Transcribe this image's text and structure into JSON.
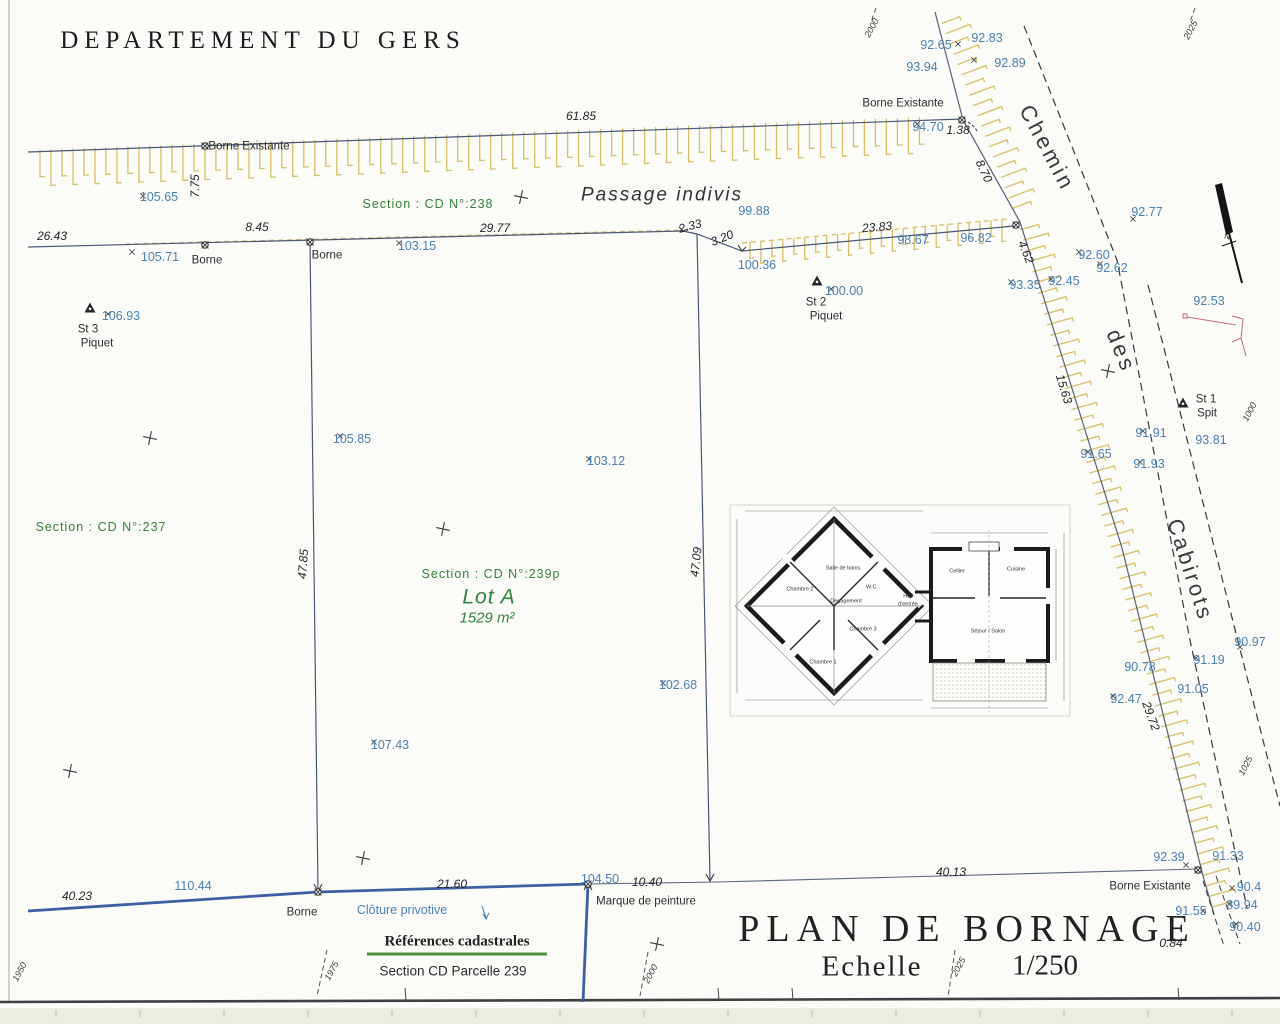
{
  "title_block": {
    "department": "DEPARTEMENT DU GERS",
    "plan_title": "PLAN DE BORNAGE",
    "scale_label": "Echelle",
    "scale_value": "1/250",
    "cadastral_title": "Références cadastrales",
    "cadastral_value": "Section CD Parcelle 239"
  },
  "colors": {
    "boundary_line": "#4a5878",
    "fence_blue": "#3c60a2",
    "hatch_yellow": "#d6bf67",
    "level_text_blue": "#4b82b2",
    "section_text_green": "#37823c",
    "detail_pink": "#c4697f"
  },
  "road": {
    "name": [
      "Chemin",
      "des",
      "Cabirots"
    ]
  },
  "labels": [
    {
      "name": "borne-existante-top-label",
      "text": "Borne Existante",
      "x": 249,
      "y": 147,
      "cls": "dark"
    },
    {
      "name": "borne-label-1",
      "text": "Borne",
      "x": 207,
      "y": 261,
      "cls": "dark"
    },
    {
      "name": "borne-label-2",
      "text": "Borne",
      "x": 327,
      "y": 256,
      "cls": "dark"
    },
    {
      "name": "borne-existante-topright-label",
      "text": "Borne Existante",
      "x": 903,
      "y": 104,
      "cls": "dark"
    },
    {
      "name": "station-3-label",
      "text": "St 3",
      "x": 88,
      "y": 330,
      "cls": "dark"
    },
    {
      "name": "station-3-type",
      "text": "Piquet",
      "x": 97,
      "y": 344,
      "cls": "dark"
    },
    {
      "name": "station-2-label",
      "text": "St 2",
      "x": 816,
      "y": 303,
      "cls": "dark"
    },
    {
      "name": "station-2-type",
      "text": "Piquet",
      "x": 826,
      "y": 317,
      "cls": "dark"
    },
    {
      "name": "station-1-label",
      "text": "St 1",
      "x": 1206,
      "y": 400,
      "cls": "dark"
    },
    {
      "name": "station-1-type",
      "text": "Spit",
      "x": 1207,
      "y": 414,
      "cls": "dark"
    },
    {
      "name": "borne-label-bottom",
      "text": "Borne",
      "x": 302,
      "y": 913,
      "cls": "dark"
    },
    {
      "name": "paint-mark-label",
      "text": "Marque de peinture",
      "x": 646,
      "y": 902,
      "cls": "dark"
    },
    {
      "name": "borne-existante-bottomright-label",
      "text": "Borne Existante",
      "x": 1150,
      "y": 887,
      "cls": "dark"
    },
    {
      "name": "passage-indivis-label",
      "text": "Passage indivis",
      "x": 662,
      "y": 195,
      "cls": "passage"
    },
    {
      "name": "road-name-chemin",
      "text": "Chemin",
      "x": 1047,
      "y": 148,
      "rot": 62,
      "cls": "road"
    },
    {
      "name": "road-name-des",
      "text": "des",
      "x": 1121,
      "y": 351,
      "rot": 68,
      "cls": "road"
    },
    {
      "name": "road-name-cabirots",
      "text": "Cabirots",
      "x": 1190,
      "y": 570,
      "rot": 72,
      "cls": "road"
    },
    {
      "name": "section-238-label",
      "text": "Section : CD N°:238",
      "x": 428,
      "y": 204,
      "cls": "green sect"
    },
    {
      "name": "section-237-label",
      "text": "Section : CD N°:237",
      "x": 101,
      "y": 527,
      "cls": "green sect"
    },
    {
      "name": "section-239p-label",
      "text": "Section : CD N°:239p",
      "x": 491,
      "y": 574,
      "cls": "green sect"
    },
    {
      "name": "lot-a-label",
      "text": "Lot A",
      "x": 489,
      "y": 597,
      "cls": "lot"
    },
    {
      "name": "lot-a-area",
      "text": "1529 m²",
      "x": 487,
      "y": 618,
      "cls": "area"
    },
    {
      "name": "dim-61-85",
      "text": "61.85",
      "x": 581,
      "y": 116,
      "cls": "dist"
    },
    {
      "name": "dim-26-43",
      "text": "26.43",
      "x": 52,
      "y": 236,
      "cls": "dist"
    },
    {
      "name": "dim-8-45",
      "text": "8.45",
      "x": 257,
      "y": 227,
      "cls": "dist"
    },
    {
      "name": "dim-29-77",
      "text": "29.77",
      "x": 495,
      "y": 228,
      "cls": "dist"
    },
    {
      "name": "dim-2-33",
      "text": "2.33",
      "x": 690,
      "y": 226,
      "rot": -15,
      "cls": "dist"
    },
    {
      "name": "dim-3-20",
      "text": "3.20",
      "x": 722,
      "y": 238,
      "rot": -22,
      "cls": "dist"
    },
    {
      "name": "dim-23-83",
      "text": "23.83",
      "x": 877,
      "y": 227,
      "rot": -5,
      "cls": "dist"
    },
    {
      "name": "dim-7-75",
      "text": "7.75",
      "x": 195,
      "y": 186,
      "rot": -90,
      "cls": "dist"
    },
    {
      "name": "dim-8-70",
      "text": "8.70",
      "x": 984,
      "y": 171,
      "rot": 65,
      "cls": "dist"
    },
    {
      "name": "dim-4-62",
      "text": "4.62",
      "x": 1026,
      "y": 252,
      "rot": 68,
      "cls": "dist"
    },
    {
      "name": "dim-15-63",
      "text": "15.63",
      "x": 1064,
      "y": 389,
      "rot": 73,
      "cls": "dist"
    },
    {
      "name": "dim-29-72",
      "text": "29.72",
      "x": 1151,
      "y": 716,
      "rot": 70,
      "cls": "dist"
    },
    {
      "name": "dim-47-85",
      "text": "47.85",
      "x": 303,
      "y": 564,
      "rot": -86,
      "cls": "dist"
    },
    {
      "name": "dim-47-09",
      "text": "47.09",
      "x": 696,
      "y": 562,
      "rot": -84,
      "cls": "dist"
    },
    {
      "name": "dim-1-38",
      "text": "1.38",
      "x": 958,
      "y": 130,
      "cls": "dist"
    },
    {
      "name": "dim-40-23",
      "text": "40.23",
      "x": 77,
      "y": 896,
      "cls": "dist"
    },
    {
      "name": "dim-21-60",
      "text": "21.60",
      "x": 452,
      "y": 884,
      "cls": "dist"
    },
    {
      "name": "dim-10-40",
      "text": "10.40",
      "x": 647,
      "y": 882,
      "cls": "dist"
    },
    {
      "name": "dim-40-13",
      "text": "40.13",
      "x": 951,
      "y": 872,
      "cls": "dist"
    },
    {
      "name": "dim-0-84",
      "text": "0.84",
      "x": 1171,
      "y": 943,
      "cls": "dist"
    },
    {
      "name": "level-105-65",
      "text": "105.65",
      "x": 159,
      "y": 197,
      "cls": "blue"
    },
    {
      "name": "level-105-71",
      "text": "105.71",
      "x": 160,
      "y": 257,
      "cls": "blue"
    },
    {
      "name": "level-103-15",
      "text": "103.15",
      "x": 417,
      "y": 246,
      "cls": "blue"
    },
    {
      "name": "level-99-88",
      "text": "99.88",
      "x": 754,
      "y": 211,
      "cls": "blue"
    },
    {
      "name": "level-100-36",
      "text": "100.36",
      "x": 757,
      "y": 265,
      "cls": "blue"
    },
    {
      "name": "level-98-67",
      "text": "98.67",
      "x": 913,
      "y": 240,
      "cls": "blue"
    },
    {
      "name": "level-96-82",
      "text": "96.82",
      "x": 976,
      "y": 238,
      "cls": "blue"
    },
    {
      "name": "level-92-65",
      "text": "92.65",
      "x": 936,
      "y": 45,
      "cls": "blue"
    },
    {
      "name": "level-93-94",
      "text": "93.94",
      "x": 922,
      "y": 67,
      "cls": "blue"
    },
    {
      "name": "level-92-83",
      "text": "92.83",
      "x": 987,
      "y": 38,
      "cls": "blue"
    },
    {
      "name": "level-92-89",
      "text": "92.89",
      "x": 1010,
      "y": 63,
      "cls": "blue"
    },
    {
      "name": "level-94-70",
      "text": "94.70",
      "x": 928,
      "y": 127,
      "cls": "blue"
    },
    {
      "name": "level-92-77",
      "text": "92.77",
      "x": 1147,
      "y": 212,
      "cls": "blue"
    },
    {
      "name": "level-92-60",
      "text": "92.60",
      "x": 1094,
      "y": 255,
      "cls": "blue"
    },
    {
      "name": "level-92-62",
      "text": "92.62",
      "x": 1112,
      "y": 268,
      "cls": "blue"
    },
    {
      "name": "level-93-35",
      "text": "93.35",
      "x": 1025,
      "y": 285,
      "cls": "blue"
    },
    {
      "name": "level-92-45",
      "text": "92.45",
      "x": 1064,
      "y": 281,
      "cls": "blue"
    },
    {
      "name": "level-92-53",
      "text": "92.53",
      "x": 1209,
      "y": 301,
      "cls": "blue"
    },
    {
      "name": "level-106-93",
      "text": "106.93",
      "x": 121,
      "y": 316,
      "cls": "blue"
    },
    {
      "name": "level-100-00",
      "text": "100.00",
      "x": 844,
      "y": 291,
      "cls": "blue"
    },
    {
      "name": "level-105-85",
      "text": "105.85",
      "x": 352,
      "y": 439,
      "cls": "blue"
    },
    {
      "name": "level-103-12",
      "text": "103.12",
      "x": 606,
      "y": 461,
      "cls": "blue"
    },
    {
      "name": "level-102-68",
      "text": "102.68",
      "x": 678,
      "y": 685,
      "cls": "blue"
    },
    {
      "name": "level-107-43",
      "text": "107.43",
      "x": 390,
      "y": 745,
      "cls": "blue"
    },
    {
      "name": "level-91-91",
      "text": "91.91",
      "x": 1151,
      "y": 433,
      "cls": "blue"
    },
    {
      "name": "level-93-81",
      "text": "93.81",
      "x": 1211,
      "y": 440,
      "cls": "blue"
    },
    {
      "name": "level-91-65",
      "text": "91.65",
      "x": 1096,
      "y": 454,
      "cls": "blue"
    },
    {
      "name": "level-91-93",
      "text": "91.93",
      "x": 1149,
      "y": 464,
      "cls": "blue"
    },
    {
      "name": "level-90-97",
      "text": "90.97",
      "x": 1250,
      "y": 642,
      "cls": "blue"
    },
    {
      "name": "level-91-19",
      "text": "91.19",
      "x": 1209,
      "y": 660,
      "cls": "blue"
    },
    {
      "name": "level-90-78",
      "text": "90.78",
      "x": 1140,
      "y": 667,
      "cls": "blue"
    },
    {
      "name": "level-91-05",
      "text": "91.05",
      "x": 1193,
      "y": 689,
      "cls": "blue"
    },
    {
      "name": "level-92-47",
      "text": "92.47",
      "x": 1126,
      "y": 699,
      "cls": "blue"
    },
    {
      "name": "level-92-39",
      "text": "92.39",
      "x": 1169,
      "y": 857,
      "cls": "blue"
    },
    {
      "name": "level-91-33",
      "text": "91.33",
      "x": 1228,
      "y": 856,
      "cls": "blue"
    },
    {
      "name": "level-90-4",
      "text": "90.4",
      "x": 1249,
      "y": 887,
      "cls": "blue"
    },
    {
      "name": "level-89-94",
      "text": "89.94",
      "x": 1242,
      "y": 905,
      "cls": "blue"
    },
    {
      "name": "level-91-55",
      "text": "91.55",
      "x": 1191,
      "y": 911,
      "cls": "blue"
    },
    {
      "name": "level-90-40",
      "text": "90.40",
      "x": 1245,
      "y": 927,
      "cls": "blue"
    },
    {
      "name": "level-110-44",
      "text": "110.44",
      "x": 193,
      "y": 886,
      "cls": "blue"
    },
    {
      "name": "level-104-50",
      "text": "104.50",
      "x": 600,
      "y": 879,
      "cls": "blue"
    },
    {
      "name": "cloture-label",
      "text": "Clôture privotive",
      "x": 402,
      "y": 910,
      "cls": "blue"
    },
    {
      "name": "grid-2000-top",
      "text": "2000",
      "x": 872,
      "y": 28,
      "rot": -62,
      "cls": "grid"
    },
    {
      "name": "grid-2025-top",
      "text": "2025",
      "x": 1191,
      "y": 30,
      "rot": -62,
      "cls": "grid"
    },
    {
      "name": "grid-1950-bottom",
      "text": "1950",
      "x": 20,
      "y": 972,
      "rot": -62,
      "cls": "grid"
    },
    {
      "name": "grid-1975-bottom",
      "text": "1975",
      "x": 332,
      "y": 971,
      "rot": -62,
      "cls": "grid"
    },
    {
      "name": "grid-2000-bottom",
      "text": "2000",
      "x": 651,
      "y": 974,
      "rot": -62,
      "cls": "grid"
    },
    {
      "name": "grid-2025-bottom",
      "text": "2025",
      "x": 959,
      "y": 967,
      "rot": -62,
      "cls": "grid"
    },
    {
      "name": "grid-1000-right",
      "text": "1000",
      "x": 1250,
      "y": 412,
      "rot": -62,
      "cls": "grid"
    },
    {
      "name": "grid-1025-right",
      "text": "1025",
      "x": 1246,
      "y": 766,
      "rot": -62,
      "cls": "grid"
    },
    {
      "name": "north-letter",
      "text": "N",
      "x": 1227,
      "y": 237,
      "rot": 15,
      "cls": "ntiny"
    },
    {
      "name": "room-salle-de-bains",
      "text": "Salle de bains",
      "x": 843,
      "y": 569,
      "cls": "room"
    },
    {
      "name": "room-wc",
      "text": "W.C.",
      "x": 872,
      "y": 588,
      "cls": "room"
    },
    {
      "name": "room-chambre-2",
      "text": "Chambre 2",
      "x": 800,
      "y": 590,
      "cls": "room"
    },
    {
      "name": "room-degagement",
      "text": "Dégagement",
      "x": 846,
      "y": 602,
      "cls": "room"
    },
    {
      "name": "room-chambre-3",
      "text": "Chambre 3",
      "x": 863,
      "y": 630,
      "cls": "room"
    },
    {
      "name": "room-chambre-1",
      "text": "Chambre 1",
      "x": 823,
      "y": 663,
      "cls": "room"
    },
    {
      "name": "room-cellier",
      "text": "Cellier",
      "x": 957,
      "y": 572,
      "cls": "room"
    },
    {
      "name": "room-cuisine",
      "text": "Cuisine",
      "x": 1016,
      "y": 570,
      "cls": "room"
    },
    {
      "name": "room-sejour-salon",
      "text": "Séjour / Salon",
      "x": 988,
      "y": 632,
      "cls": "room"
    },
    {
      "name": "room-hall",
      "text": "Hall",
      "x": 908,
      "y": 597,
      "cls": "room"
    },
    {
      "name": "room-hall-entree",
      "text": "d'entrée",
      "x": 908,
      "y": 605,
      "cls": "room"
    }
  ]
}
